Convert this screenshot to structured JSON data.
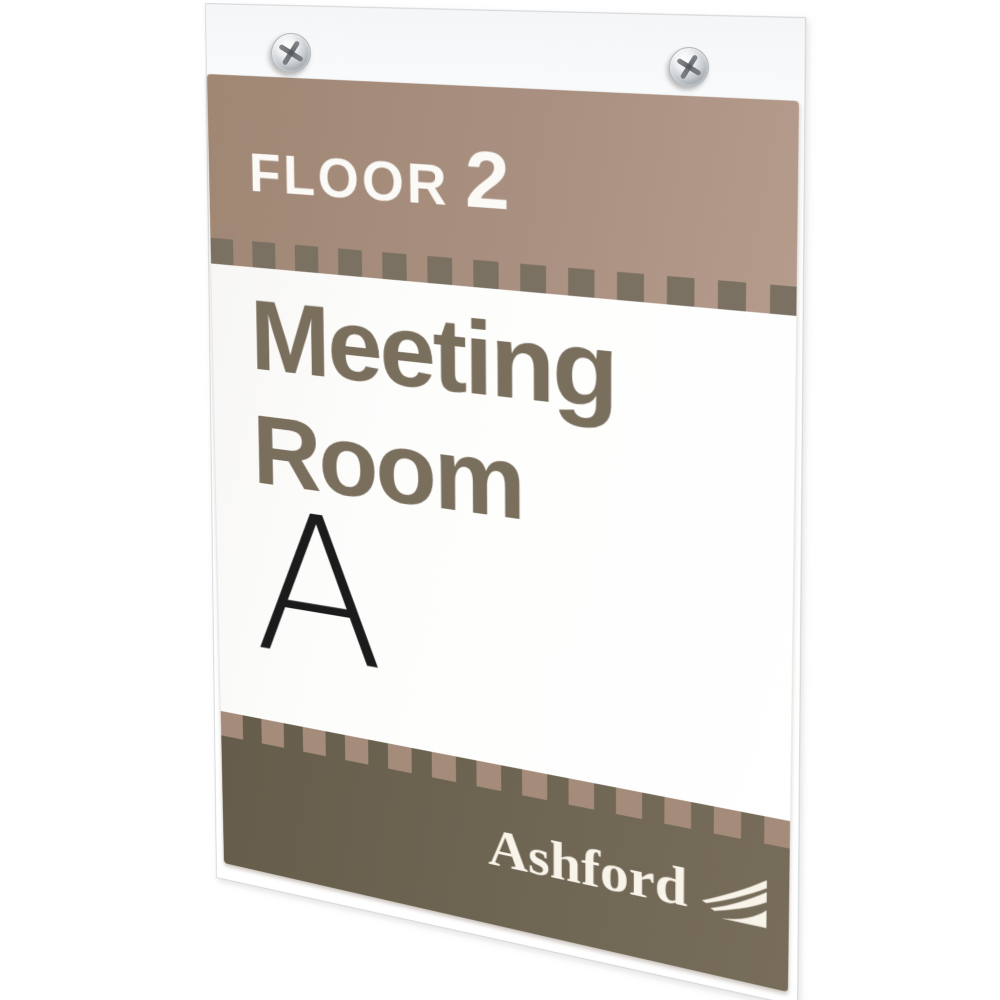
{
  "image_type": "product-photo",
  "subject": "wall-mount acrylic sign holder with printed meeting room insert",
  "sign": {
    "floor_label": "FLOOR",
    "floor_number": "2",
    "room_word_1": "Meeting",
    "room_word_2": "Room",
    "room_letter": "A",
    "brand_name": "Ashford"
  },
  "colors": {
    "background": "#ffffff",
    "band_taupe": "#a88f7f",
    "band_dark_olive": "#6f6553",
    "dash_square_dark": "#7b7162",
    "dash_square_light": "#a58c7a",
    "room_text": "#7a6e5c",
    "room_letter_black": "#1b1b1b",
    "floor_text_white": "#fbfaf7",
    "brand_text_cream": "#f8f4ea",
    "screw_chrome": "#c6cbcf"
  }
}
